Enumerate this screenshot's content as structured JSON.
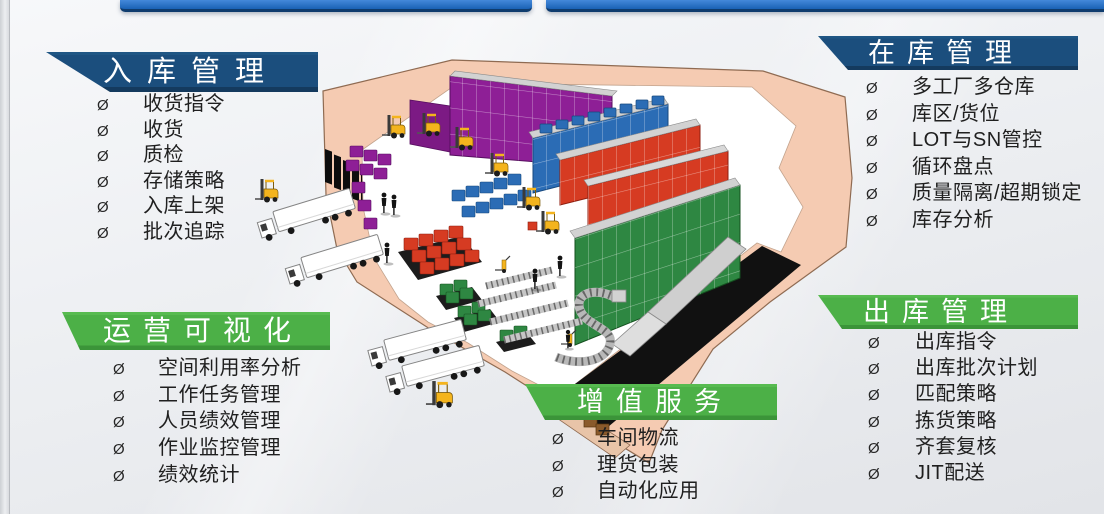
{
  "slide": {
    "bullet_char": "Ø",
    "accent_navy": "#1b4e7d",
    "accent_green": "#4cb047",
    "top_bar_blue": "#1e6ec2",
    "top_bar_edge": "#0f3c6e"
  },
  "panels": {
    "inbound": {
      "title": "入库管理",
      "header_color": "#1b4e7d",
      "items": [
        "收货指令",
        "收货",
        "质检",
        "存储策略",
        "入库上架",
        "批次追踪"
      ]
    },
    "in_stock": {
      "title": "在库管理",
      "header_color": "#1b4e7d",
      "items": [
        "多工厂多仓库",
        "库区/货位",
        "LOT与SN管控",
        "循环盘点",
        "质量隔离/超期锁定",
        "库存分析"
      ]
    },
    "operations": {
      "title": "运营可视化",
      "header_color": "#4cb047",
      "items": [
        "空间利用率分析",
        "工作任务管理",
        "人员绩效管理",
        "作业监控管理",
        "绩效统计"
      ]
    },
    "value_added": {
      "title": "增值服务",
      "header_color": "#4cb047",
      "items": [
        "车间物流",
        "理货包装",
        "自动化应用"
      ]
    },
    "outbound": {
      "title": "出库管理",
      "header_color": "#4cb047",
      "items": [
        "出库指令",
        "出库批次计划",
        "匹配策略",
        "拣货策略",
        "齐套复核",
        "JIT配送"
      ]
    }
  },
  "illustration": {
    "name": "isometric-warehouse-cutaway",
    "elements": [
      "warehouse-building",
      "loading-dock-trucks",
      "forklifts",
      "pallet-racks",
      "floor-pallets",
      "conveyor-line",
      "workers"
    ],
    "colors": {
      "wall": "#f5cbb2",
      "floor": "#ffffff",
      "rack_purple": "#8e1f96",
      "rack_blue": "#2b6cb5",
      "rack_red": "#d63b22",
      "rack_green": "#2e8742",
      "forklift": "#f4b41d",
      "truck": "#ffffff",
      "shadow": "#111111"
    }
  }
}
